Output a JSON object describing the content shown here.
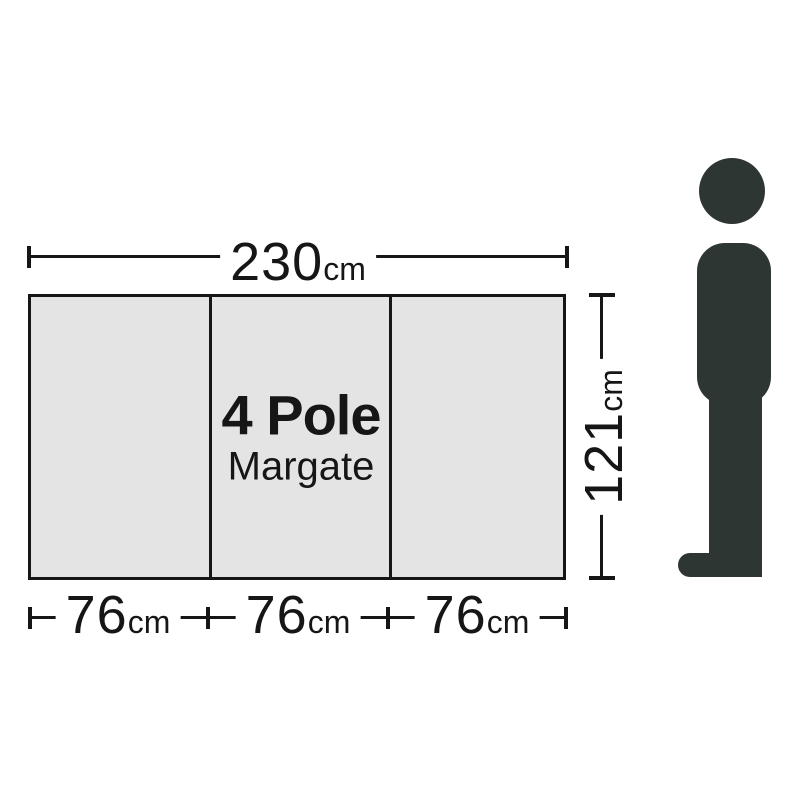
{
  "product": {
    "name_line1": "4 Pole",
    "name_line2": "Margate"
  },
  "dimensions": {
    "total_width": {
      "value": "230",
      "unit": "cm"
    },
    "height": {
      "value": "121",
      "unit": "cm"
    },
    "panel_widths": [
      {
        "value": "76",
        "unit": "cm"
      },
      {
        "value": "76",
        "unit": "cm"
      },
      {
        "value": "76",
        "unit": "cm"
      }
    ]
  },
  "colors": {
    "background": "#ffffff",
    "panel_fill": "#e4e4e4",
    "line": "#161616",
    "text": "#161616",
    "figure": "#2e3633"
  }
}
